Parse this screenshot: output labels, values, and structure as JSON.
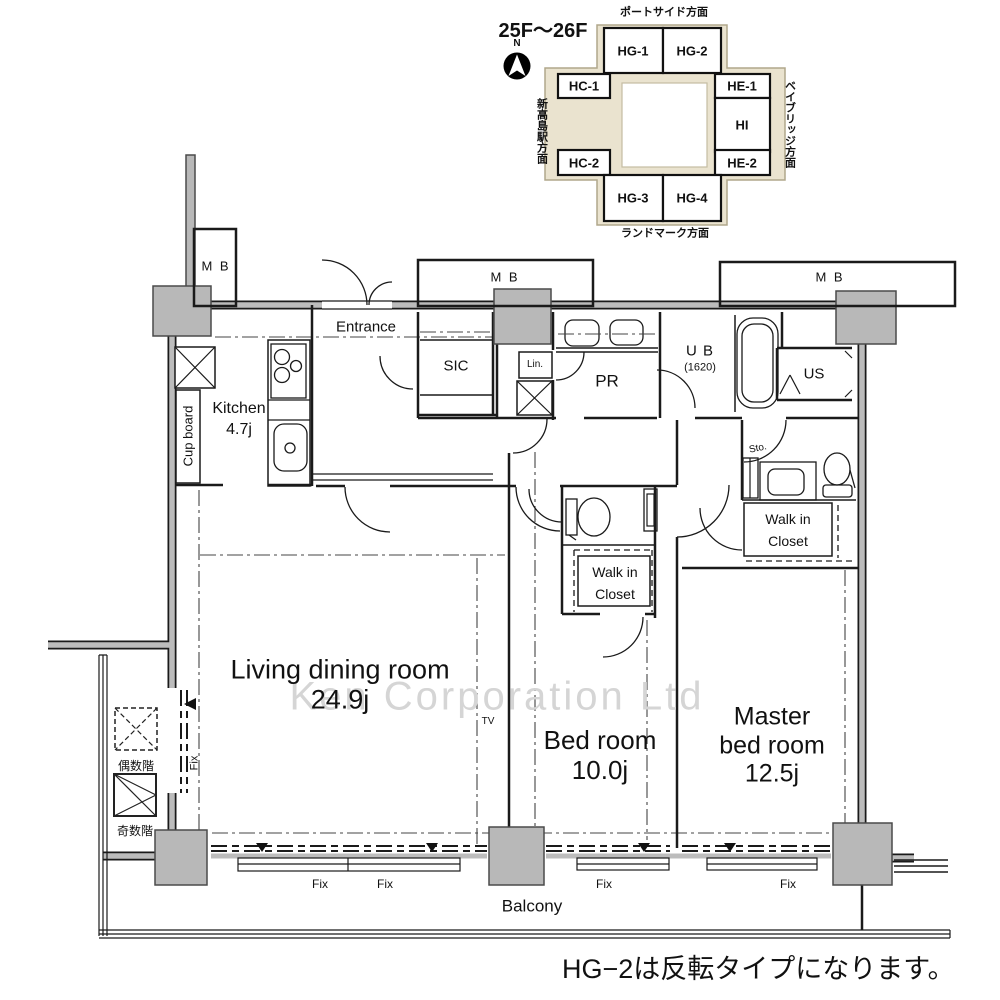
{
  "site_plan": {
    "floor_range": "25F〜26F",
    "compass_north": "N",
    "directions": {
      "top": "ポートサイド方面",
      "right": "ベイブリッジ方面",
      "bottom": "ランドマーク方面",
      "left": "新高島駅方面"
    },
    "units": [
      {
        "label": "HG-1"
      },
      {
        "label": "HG-2"
      },
      {
        "label": "HC-1"
      },
      {
        "label": "HE-1"
      },
      {
        "label": "HI"
      },
      {
        "label": "HC-2"
      },
      {
        "label": "HE-2"
      },
      {
        "label": "HG-3"
      },
      {
        "label": "HG-4"
      }
    ]
  },
  "floor_plan": {
    "rooms": {
      "kitchen_name": "Kitchen",
      "kitchen_size": "4.7j",
      "cupboard": "Cup board",
      "entrance": "Entrance",
      "sic": "SIC",
      "linen": "Lin.",
      "powder_room": "PR",
      "bath_name": "U B",
      "bath_size": "(1620)",
      "utility": "US",
      "storage": "Sto.",
      "wic_line1": "Walk in",
      "wic_line2": "Closet",
      "living_name": "Living dining room",
      "living_size": "24.9j",
      "tv": "TV",
      "bedroom_name": "Bed room",
      "bedroom_size": "10.0j",
      "master_line1": "Master",
      "master_line2": "bed room",
      "master_size": "12.5j",
      "balcony": "Balcony"
    },
    "labels": {
      "meter_box": "M B",
      "fix": "Fix",
      "elevator_even": "偶数階",
      "elevator_odd": "奇数階"
    }
  },
  "watermark": "Ken Corporation Ltd",
  "note": "HG−2は反転タイプになります。",
  "colors": {
    "building_fill": "#eae3cf",
    "wall_gray": "#bcbcbc",
    "line_black": "#1a1a1a"
  }
}
